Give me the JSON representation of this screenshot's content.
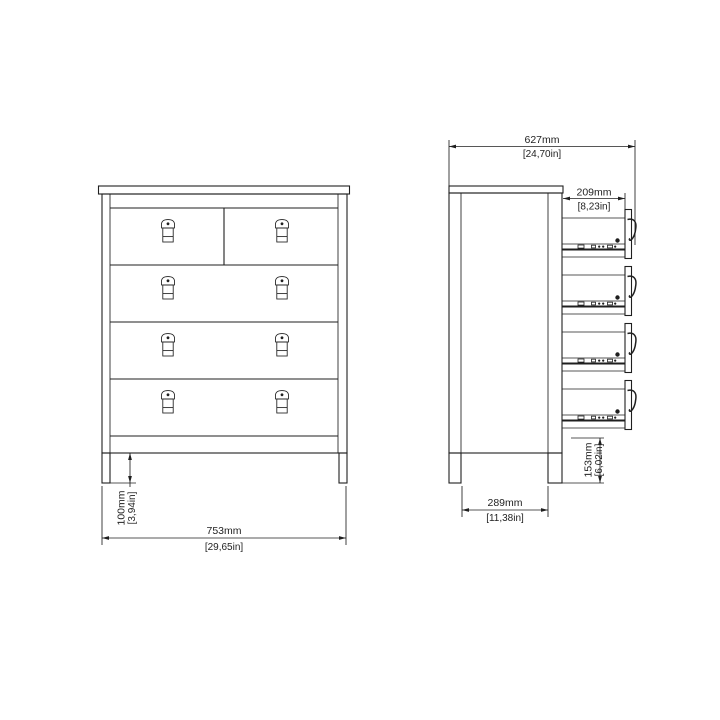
{
  "colors": {
    "ink": "#1f1f1f",
    "paper": "#ffffff"
  },
  "front_view": {
    "width": {
      "mm": "753mm",
      "in": "[29,65in]"
    },
    "leg_height": {
      "mm": "100mm",
      "in": "[3,94in]"
    }
  },
  "side_view": {
    "open_depth": {
      "mm": "627mm",
      "in": "[24,70in]"
    },
    "drawer_extension": {
      "mm": "209mm",
      "in": "[8,23in]"
    },
    "base_depth": {
      "mm": "289mm",
      "in": "[11,38in]"
    },
    "drawer_bottom_height": {
      "mm": "153mm",
      "in": "[6,02in]"
    }
  }
}
